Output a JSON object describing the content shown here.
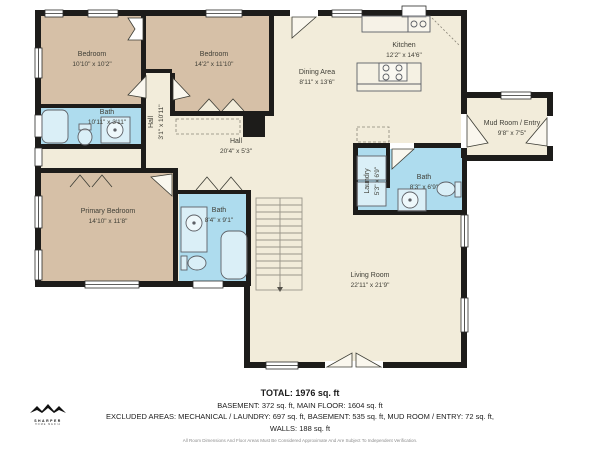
{
  "colors": {
    "wall": "#1d1c1a",
    "floor_cream": "#f2ecda",
    "bedroom_tan": "#d6c0a7",
    "bath_blue": "#aedcee",
    "text": "#3f3e36"
  },
  "rooms": [
    {
      "id": "bedroom-1",
      "name": "Bedroom",
      "dims": "10'10\" x 10'2\""
    },
    {
      "id": "bedroom-2",
      "name": "Bedroom",
      "dims": "14'2\" x 11'10\""
    },
    {
      "id": "bath-1",
      "name": "Bath",
      "dims": "10'11\" x 3'11\""
    },
    {
      "id": "hall-vertical",
      "name": "Hall",
      "dims": "3'1\" x 10'11\""
    },
    {
      "id": "hall",
      "name": "Hall",
      "dims": "20'4\" x 5'3\""
    },
    {
      "id": "primary-bedroom",
      "name": "Primary Bedroom",
      "dims": "14'10\" x 11'8\""
    },
    {
      "id": "bath-2",
      "name": "Bath",
      "dims": "8'4\" x 9'1\""
    },
    {
      "id": "dining-area",
      "name": "Dining Area",
      "dims": "8'11\" x 13'6\""
    },
    {
      "id": "kitchen",
      "name": "Kitchen",
      "dims": "12'2\" x 14'6\""
    },
    {
      "id": "mud-room",
      "name": "Mud Room / Entry",
      "dims": "9'8\" x 7'5\""
    },
    {
      "id": "laundry",
      "name": "Laundry",
      "dims": "5'3\" x 6'9\""
    },
    {
      "id": "bath-3",
      "name": "Bath",
      "dims": "8'3\" x 6'9\""
    },
    {
      "id": "living-room",
      "name": "Living Room",
      "dims": "22'11\" x 21'9\""
    }
  ],
  "footer": {
    "total": "TOTAL: 1976 sq. ft",
    "line_main": "BASEMENT: 372 sq. ft, MAIN FLOOR: 1604 sq. ft",
    "line_excluded": "EXCLUDED AREAS: MECHANICAL / LAUNDRY: 697 sq. ft, BASEMENT: 535 sq. ft, MUD ROOM / ENTRY: 72 sq. ft,",
    "line_walls": "WALLS: 188 sq. ft",
    "disclaimer": "All Room Dimensions And Floor Areas Must Be Considered Approximate And Are Subject To Independent Verification."
  },
  "brand": {
    "name": "SHARPER",
    "tagline": "HOME MEDIA"
  }
}
